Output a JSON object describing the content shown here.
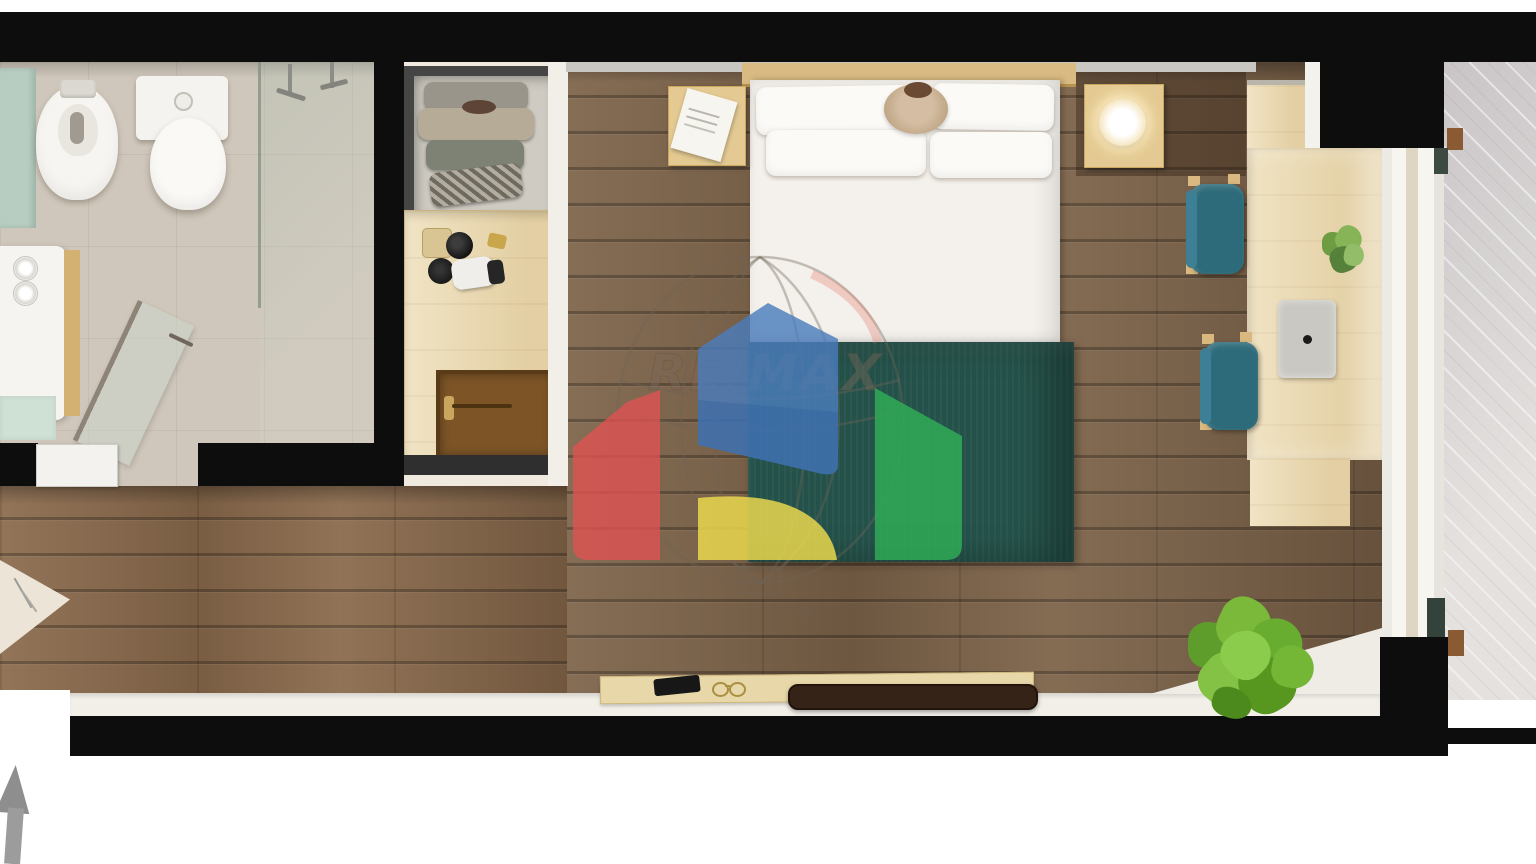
{
  "watermark": {
    "brand": "RE/MAX",
    "registered_mark": "®"
  },
  "colors": {
    "wall_black": "#0d0d0d",
    "floor_wood": "#7d6349",
    "floor_wood_light": "#8a6a4c",
    "bathroom_tile": "#cfc7bb",
    "mint_accent": "#b7cdc1",
    "balcony_tile": "#dbd7d4",
    "light_wood": "#ecdbb1",
    "bench_wood": "#e8d7a9",
    "headboard_wood": "#d9ba82",
    "blanket_teal": "#24524a",
    "chair_teal": "#2e6b7a",
    "plant_green": "#6cae35",
    "mat_brown": "#7c5426",
    "arrow_gray": "#8e8e8e",
    "remax_red": "#e25252",
    "remax_blue": "#4a7cbc",
    "remax_yellow": "#e9d74d",
    "remax_green": "#2fae57"
  },
  "scene": {
    "type": "studio-apartment-floor-plan-rendering",
    "visible_objects": [
      "bidet",
      "toilet",
      "walk-in-shower",
      "shower-glass-door",
      "sink-vanity",
      "towel-rolls",
      "wardrobe-shelves",
      "minibar-counter",
      "luggage-mat",
      "double-bed",
      "pillows",
      "teal-duvet",
      "nightstand-with-notebook",
      "nightstand-with-lamp",
      "desk",
      "desk-plant",
      "laptop",
      "teal-chair",
      "teal-chair",
      "balcony",
      "sliding-door-frame",
      "corner-plant",
      "window-bench",
      "remote-control",
      "eyeglasses",
      "media-bar",
      "north-arrow",
      "remax-balloon-watermark"
    ]
  }
}
